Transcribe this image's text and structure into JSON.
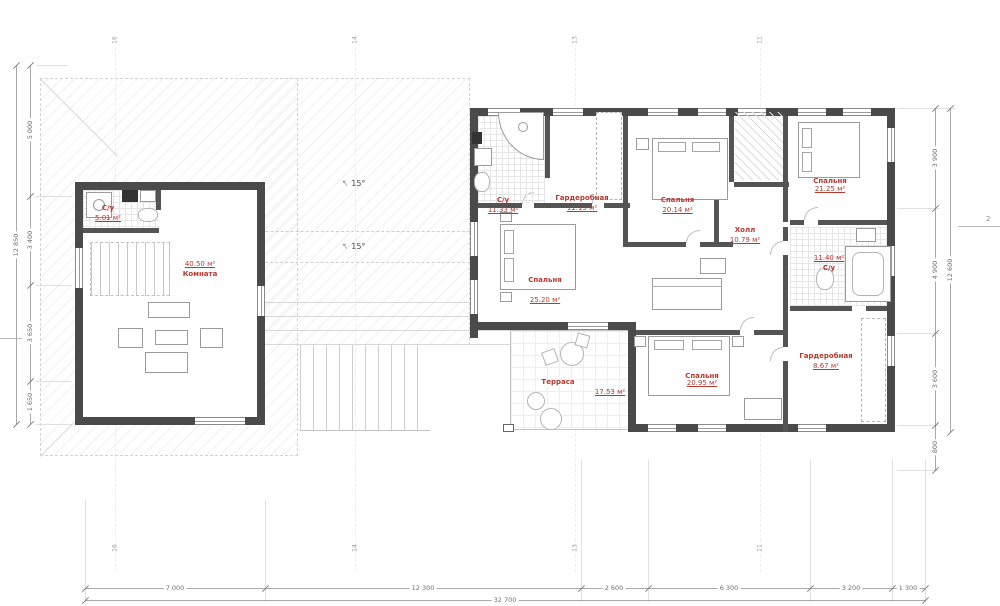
{
  "rooms": [
    {
      "name": "С/у",
      "area": "5.01 м²"
    },
    {
      "name": "Комната",
      "area": "40.50 м²"
    },
    {
      "name": "С/у",
      "area": "11.33 м²"
    },
    {
      "name": "Гардеробная",
      "area": "11.13 м²"
    },
    {
      "name": "Спальня",
      "area": "20.14 м²"
    },
    {
      "name": "Спальня",
      "area": "21.25 м²"
    },
    {
      "name": "Холл",
      "area": "10.79 м²"
    },
    {
      "name": "С/у",
      "area": "11.40 м²"
    },
    {
      "name": "Спальня",
      "area": "25.20 м²"
    },
    {
      "name": "Гардеробная",
      "area": "8.67 м²"
    },
    {
      "name": "Спальня",
      "area": "20.95 м²"
    },
    {
      "name": "Терраса",
      "area": "17.53 м²"
    }
  ],
  "slopes": [
    {
      "icon": "↑",
      "label": "15°"
    },
    {
      "icon": "↑",
      "label": "15°"
    }
  ],
  "dims": {
    "bottom": {
      "segments": [
        "7 000",
        "12 300",
        "2 600",
        "6 300",
        "3 200",
        "1 300"
      ],
      "total": "32 700"
    },
    "left": {
      "segments": [
        "5 000",
        "3 400",
        "3 650",
        "1 650"
      ],
      "total": "12 850"
    },
    "right": {
      "segments": [
        "3 900",
        "4 900",
        "3 600",
        "800"
      ],
      "total": "12 600"
    }
  },
  "axes": {
    "ticks": [
      "16",
      "14",
      "13",
      "11"
    ]
  },
  "markers": {
    "section": "2"
  }
}
